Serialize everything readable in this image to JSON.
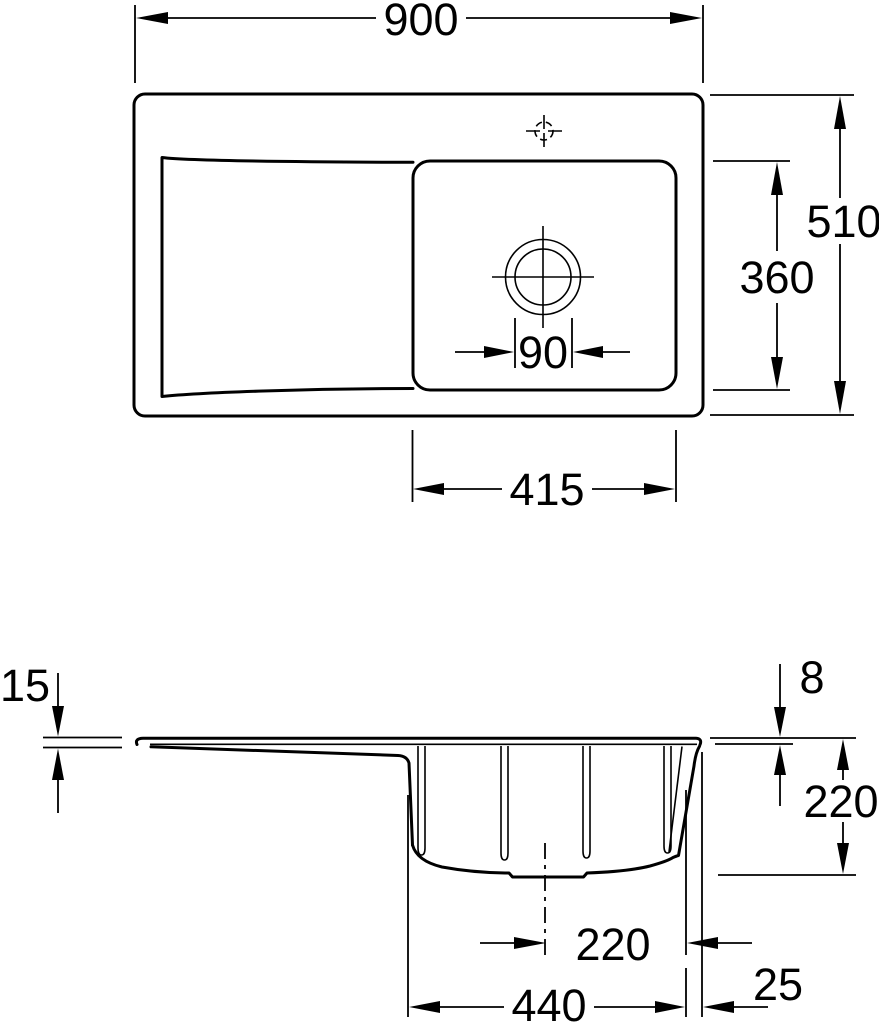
{
  "drawing": {
    "type": "technical-dimension-drawing",
    "subject": "kitchen sink with drainer and single bowl",
    "views": {
      "top": "plan view",
      "side": "front section view"
    },
    "units": "mm"
  },
  "colors": {
    "line": "#000000",
    "background": "#ffffff"
  },
  "dims": {
    "overall_width": {
      "label": "900",
      "value_mm": 900
    },
    "overall_depth": {
      "label": "510",
      "value_mm": 510
    },
    "bowl_depth": {
      "label": "360",
      "value_mm": 360
    },
    "drain_diameter": {
      "label": "90",
      "value_mm": 90
    },
    "bowl_offset": {
      "label": "415",
      "value_mm": 415
    },
    "rim_front_height": {
      "label": "15",
      "value_mm": 15
    },
    "rim_back_height": {
      "label": "8",
      "value_mm": 8
    },
    "bowl_inner_depth": {
      "label": "220",
      "value_mm": 220
    },
    "drain_center_offset": {
      "label": "220",
      "value_mm": 220
    },
    "rim_overhang": {
      "label": "25",
      "value_mm": 25
    },
    "bowl_width": {
      "label": "440",
      "value_mm": 440
    }
  }
}
